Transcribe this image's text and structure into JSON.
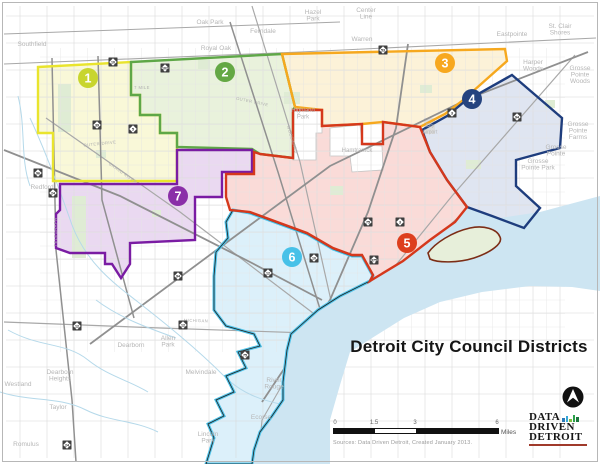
{
  "title": "Detroit City Council Districts",
  "source": "Sources: Data Driven Detroit, Created January 2013.",
  "scalebar": {
    "ticks": [
      "0",
      "1.5",
      "3",
      "6"
    ],
    "unit": "Miles"
  },
  "logo": {
    "lines": [
      "DATA",
      "DRIVEN",
      "DETROIT"
    ],
    "bars": [
      {
        "h": 4,
        "c": "#2b7bb9"
      },
      {
        "h": 6,
        "c": "#37a7d7"
      },
      {
        "h": 3,
        "c": "#7dc242"
      },
      {
        "h": 7,
        "c": "#2aa04a"
      },
      {
        "h": 5,
        "c": "#1d7a3e"
      }
    ]
  },
  "map": {
    "water_color": "#cde5f2",
    "river_color": "#b5d9ea",
    "park_color": "#dfecd4",
    "airport_color": "#dcdcdc",
    "label_color": "#b6b6b6",
    "road_label_color": "#b0b0b0",
    "belle_isle": {
      "fill": "#e7efda",
      "stroke": "#7c2d16"
    },
    "districts": [
      {
        "number": "1",
        "badge_color": "#c8d52e",
        "fill": "#f9f8d8",
        "stroke": "#e9e42d",
        "badge": {
          "x": 88,
          "y": 78
        }
      },
      {
        "number": "2",
        "badge_color": "#64a844",
        "fill": "#e9f2dc",
        "stroke": "#5ea747",
        "badge": {
          "x": 225,
          "y": 72
        }
      },
      {
        "number": "3",
        "badge_color": "#f7a81f",
        "fill": "#fcf2d8",
        "stroke": "#f6a81e",
        "badge": {
          "x": 445,
          "y": 63
        }
      },
      {
        "number": "4",
        "badge_color": "#25437f",
        "fill": "#dfe5f1",
        "stroke": "#1e3d7d",
        "badge": {
          "x": 472,
          "y": 99
        }
      },
      {
        "number": "5",
        "badge_color": "#dd3f1e",
        "fill": "#fadbd8",
        "stroke": "#d5381c",
        "badge": {
          "x": 407,
          "y": 243
        }
      },
      {
        "number": "6",
        "badge_color": "#47c1e8",
        "fill": "#dcf0fa",
        "stroke": "#4fc3e9",
        "badge": {
          "x": 292,
          "y": 257
        }
      },
      {
        "number": "7",
        "badge_color": "#8a2fa8",
        "fill": "#ead9f1",
        "stroke": "#7a1ca3",
        "badge": {
          "x": 178,
          "y": 196
        }
      }
    ],
    "labels": [
      {
        "lines": [
          "Southfield"
        ],
        "x": 32,
        "y": 46
      },
      {
        "lines": [
          "Oak Park"
        ],
        "x": 210,
        "y": 24
      },
      {
        "lines": [
          "Royal Oak"
        ],
        "x": 216,
        "y": 50
      },
      {
        "lines": [
          "Ferndale"
        ],
        "x": 263,
        "y": 33
      },
      {
        "lines": [
          "Hazel",
          "Park"
        ],
        "x": 313,
        "y": 14
      },
      {
        "lines": [
          "Center",
          "Line"
        ],
        "x": 366,
        "y": 12
      },
      {
        "lines": [
          "Warren"
        ],
        "x": 362,
        "y": 41
      },
      {
        "lines": [
          "Eastpointe"
        ],
        "x": 512,
        "y": 36
      },
      {
        "lines": [
          "St. Clair",
          "Shores"
        ],
        "x": 560,
        "y": 28
      },
      {
        "lines": [
          "Harper",
          "Woods"
        ],
        "x": 533,
        "y": 64
      },
      {
        "lines": [
          "Grosse",
          "Pointe",
          "Woods"
        ],
        "x": 580,
        "y": 70
      },
      {
        "lines": [
          "Grosse",
          "Pointe",
          "Farms"
        ],
        "x": 578,
        "y": 126
      },
      {
        "lines": [
          "Grosse",
          "Pointe"
        ],
        "x": 556,
        "y": 149
      },
      {
        "lines": [
          "Grosse",
          "Pointe Park"
        ],
        "x": 538,
        "y": 163
      },
      {
        "lines": [
          "Highland",
          "Park"
        ],
        "x": 303,
        "y": 112,
        "s": 6
      },
      {
        "lines": [
          "Hamtramck"
        ],
        "x": 357,
        "y": 152,
        "s": 6
      },
      {
        "lines": [
          "City",
          "Airport"
        ],
        "x": 430,
        "y": 127,
        "s": 5
      },
      {
        "lines": [
          "Redford"
        ],
        "x": 42,
        "y": 189
      },
      {
        "lines": [
          "Westland"
        ],
        "x": 18,
        "y": 386
      },
      {
        "lines": [
          "Dearborn",
          "Heights"
        ],
        "x": 60,
        "y": 374
      },
      {
        "lines": [
          "Dearborn"
        ],
        "x": 131,
        "y": 347
      },
      {
        "lines": [
          "Taylor"
        ],
        "x": 58,
        "y": 409
      },
      {
        "lines": [
          "Romulus"
        ],
        "x": 26,
        "y": 446
      },
      {
        "lines": [
          "Allen",
          "Park"
        ],
        "x": 168,
        "y": 340
      },
      {
        "lines": [
          "Melvindale"
        ],
        "x": 201,
        "y": 374
      },
      {
        "lines": [
          "Lincoln",
          "Park"
        ],
        "x": 208,
        "y": 436
      },
      {
        "lines": [
          "River",
          "Rouge"
        ],
        "x": 274,
        "y": 382
      },
      {
        "lines": [
          "Ecorse"
        ],
        "x": 261,
        "y": 419
      }
    ],
    "road_labels": [
      {
        "t": "OUTER DRIVE",
        "x": 100,
        "y": 145,
        "r": -6
      },
      {
        "t": "OUTER DRIVE",
        "x": 252,
        "y": 103,
        "r": 12
      },
      {
        "t": "7 MILE",
        "x": 142,
        "y": 89,
        "r": 0
      },
      {
        "t": "TELEGRAPH",
        "x": 57,
        "y": 232,
        "r": -90
      },
      {
        "t": "GRAND RIVER",
        "x": 122,
        "y": 174,
        "r": 35
      },
      {
        "t": "MICHIGAN",
        "x": 196,
        "y": 322,
        "r": 2
      },
      {
        "t": "WOODWARD",
        "x": 291,
        "y": 140,
        "r": 73
      }
    ],
    "shields": [
      {
        "n": "10",
        "x": 113,
        "y": 62
      },
      {
        "n": "102",
        "x": 165,
        "y": 68
      },
      {
        "n": "39",
        "x": 97,
        "y": 125
      },
      {
        "n": "5",
        "x": 133,
        "y": 129
      },
      {
        "n": "53",
        "x": 383,
        "y": 50
      },
      {
        "n": "3",
        "x": 452,
        "y": 113
      },
      {
        "n": "94",
        "x": 517,
        "y": 117
      },
      {
        "n": "96",
        "x": 38,
        "y": 173
      },
      {
        "n": "24",
        "x": 53,
        "y": 193
      },
      {
        "n": "75",
        "x": 368,
        "y": 222
      },
      {
        "n": "3",
        "x": 400,
        "y": 222
      },
      {
        "n": "375",
        "x": 374,
        "y": 260
      },
      {
        "n": "10",
        "x": 314,
        "y": 258
      },
      {
        "n": "12",
        "x": 268,
        "y": 273
      },
      {
        "n": "75",
        "x": 245,
        "y": 355
      },
      {
        "n": "94",
        "x": 178,
        "y": 276
      },
      {
        "n": "12",
        "x": 77,
        "y": 326
      },
      {
        "n": "12",
        "x": 183,
        "y": 325
      },
      {
        "n": "24",
        "x": 67,
        "y": 445
      }
    ]
  }
}
